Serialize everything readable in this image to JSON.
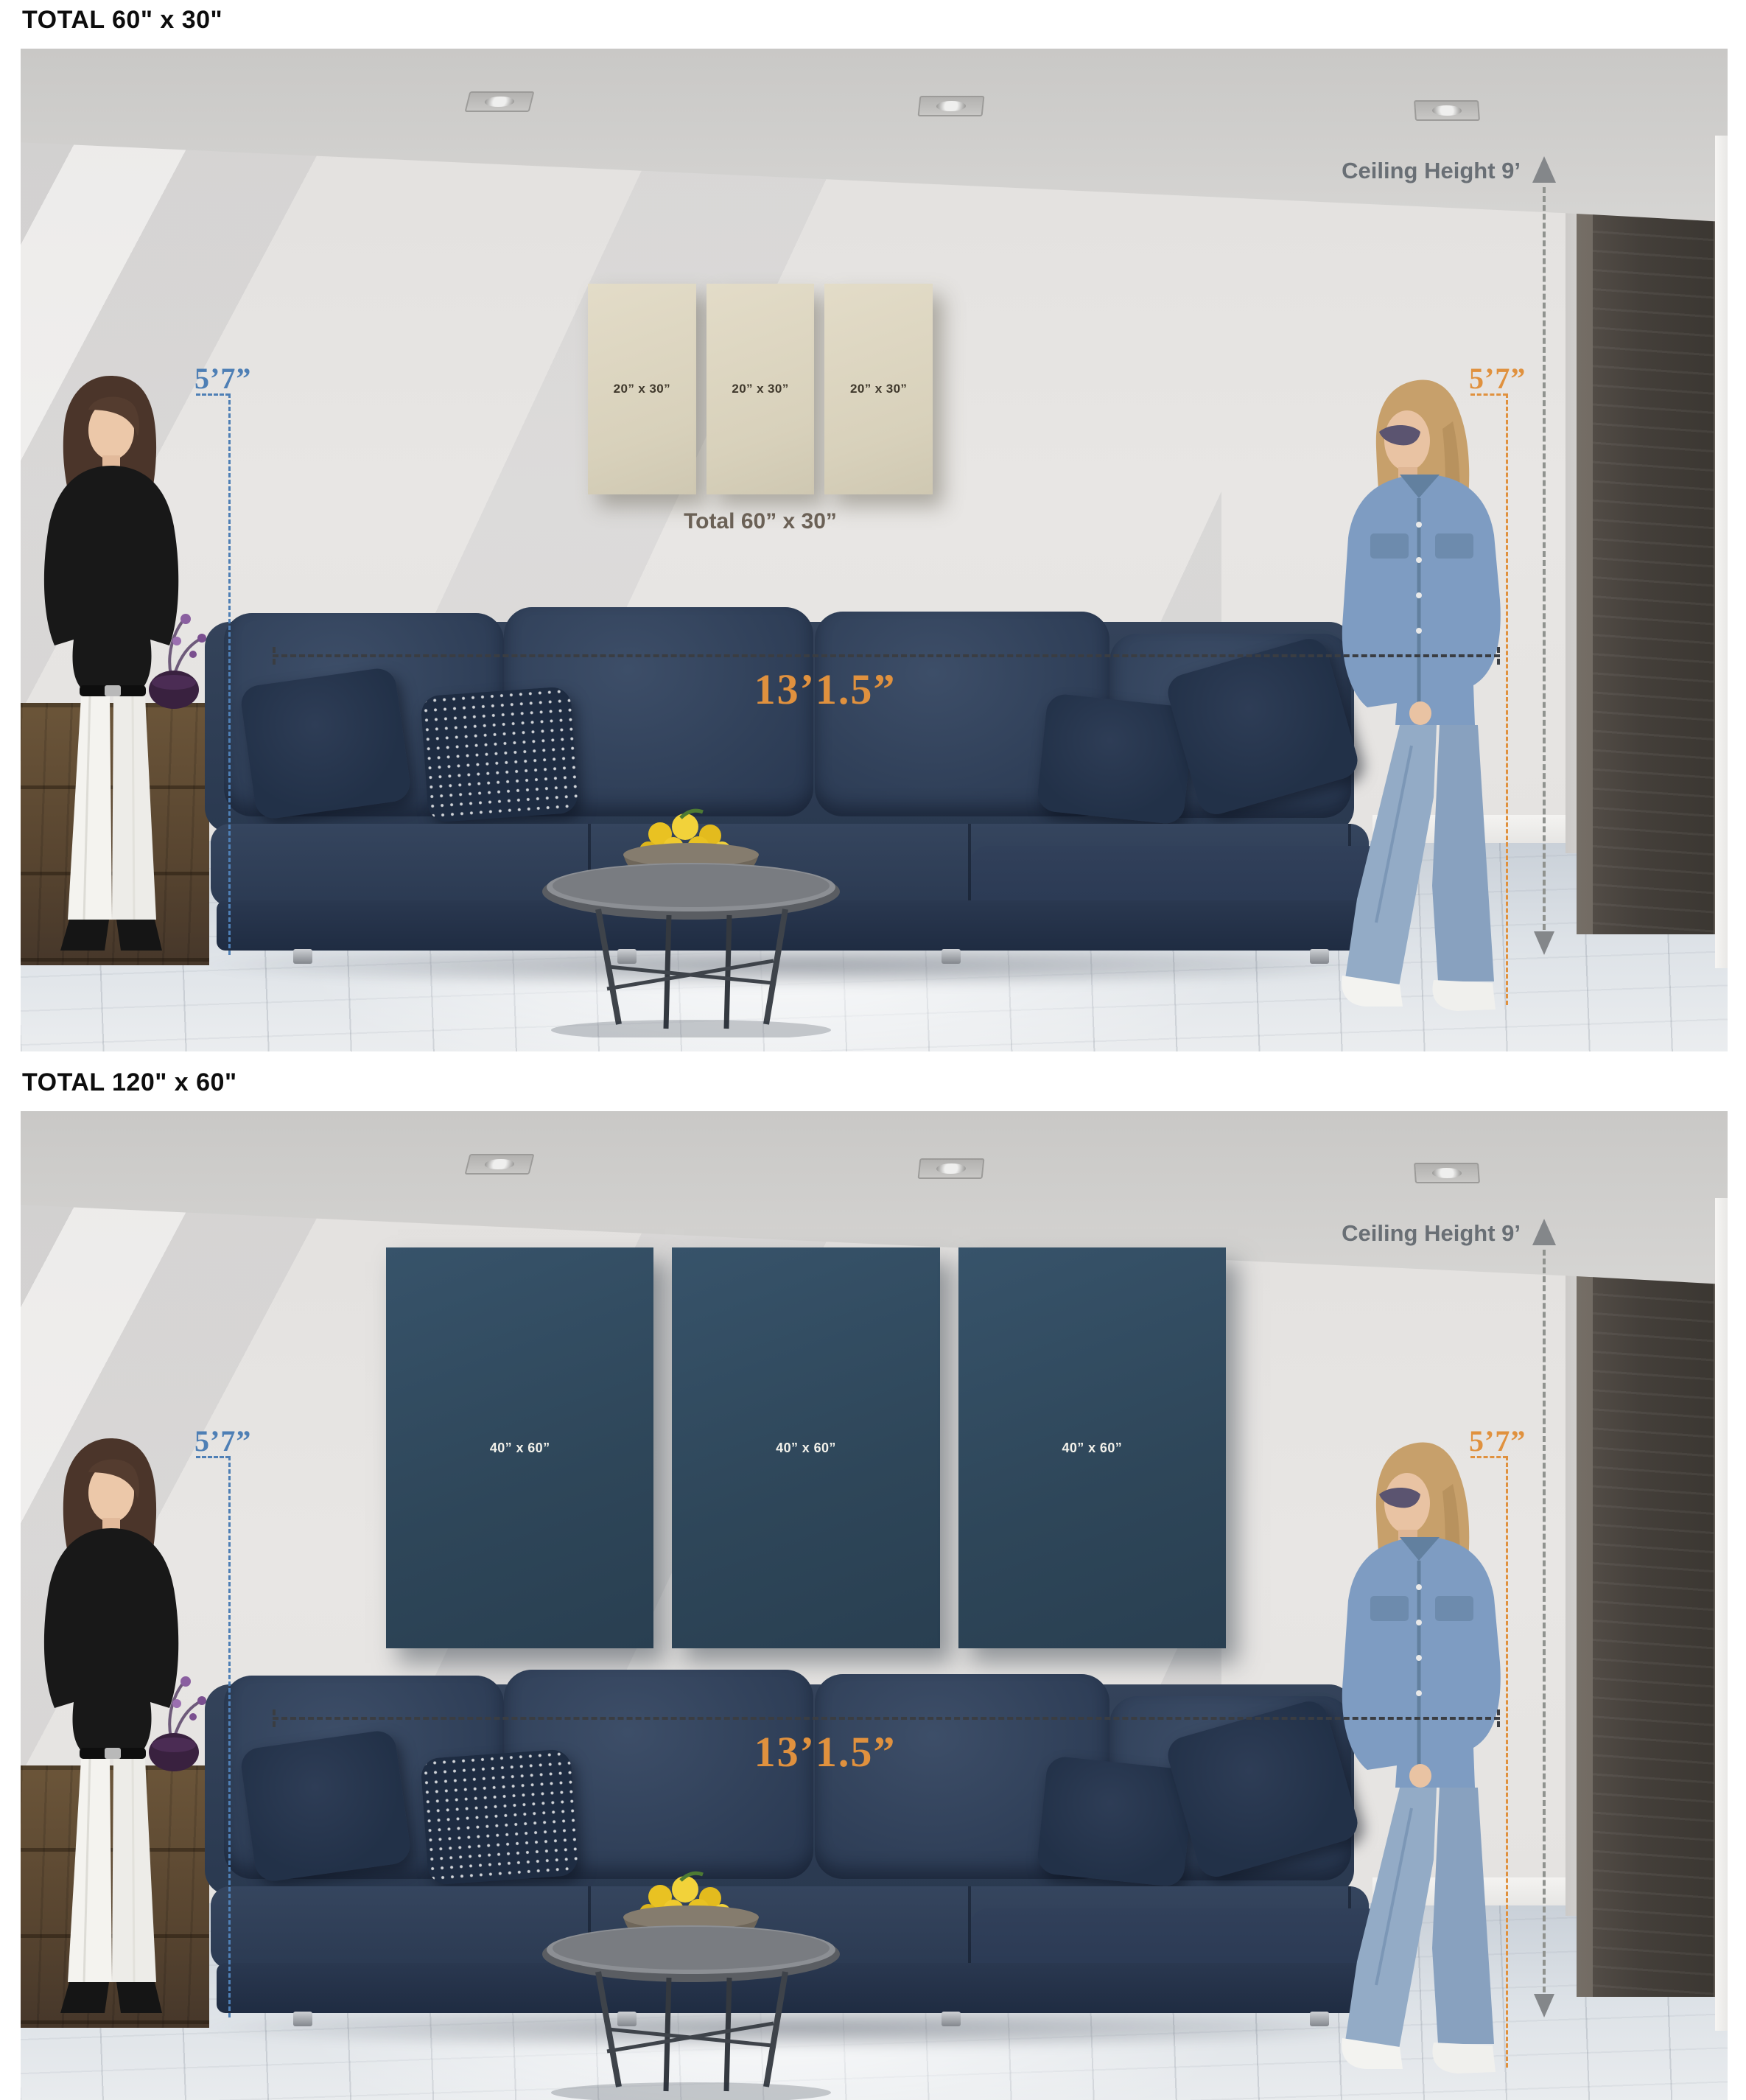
{
  "colors": {
    "accent_orange": "#e0913e",
    "accent_blue": "#4e7fb5",
    "annotation_gray": "#696f75",
    "canvas_beige": "#ddd6c1",
    "canvas_dark": "#31495c",
    "total_gray": "#6b6156",
    "total_navy": "#2c3e52",
    "wall": "#e6e4e2",
    "floor": "#dde2e7",
    "sofa": "#2c3a4d",
    "header_text": "#0d0d0d"
  },
  "panels": [
    {
      "header": "TOTAL 60\" x 30\"",
      "canvases": [
        {
          "label": "20” x 30”"
        },
        {
          "label": "20” x 30”"
        },
        {
          "label": "20” x 30”"
        }
      ],
      "total_label": "Total 60” x 30”",
      "width_dimension": "13’1.5”",
      "ceiling_height_label": "Ceiling Height 9’",
      "left_person_height": "5’7”",
      "right_person_height": "5’7”"
    },
    {
      "header": "TOTAL 120\" x 60\"",
      "canvases": [
        {
          "label": "40” x 60”"
        },
        {
          "label": "40” x 60”"
        },
        {
          "label": "40” x 60”"
        }
      ],
      "total_label": "Total 120” x 60”",
      "width_dimension": "13’1.5”",
      "ceiling_height_label": "Ceiling Height 9’",
      "left_person_height": "5’7”",
      "right_person_height": "5’7”"
    }
  ]
}
